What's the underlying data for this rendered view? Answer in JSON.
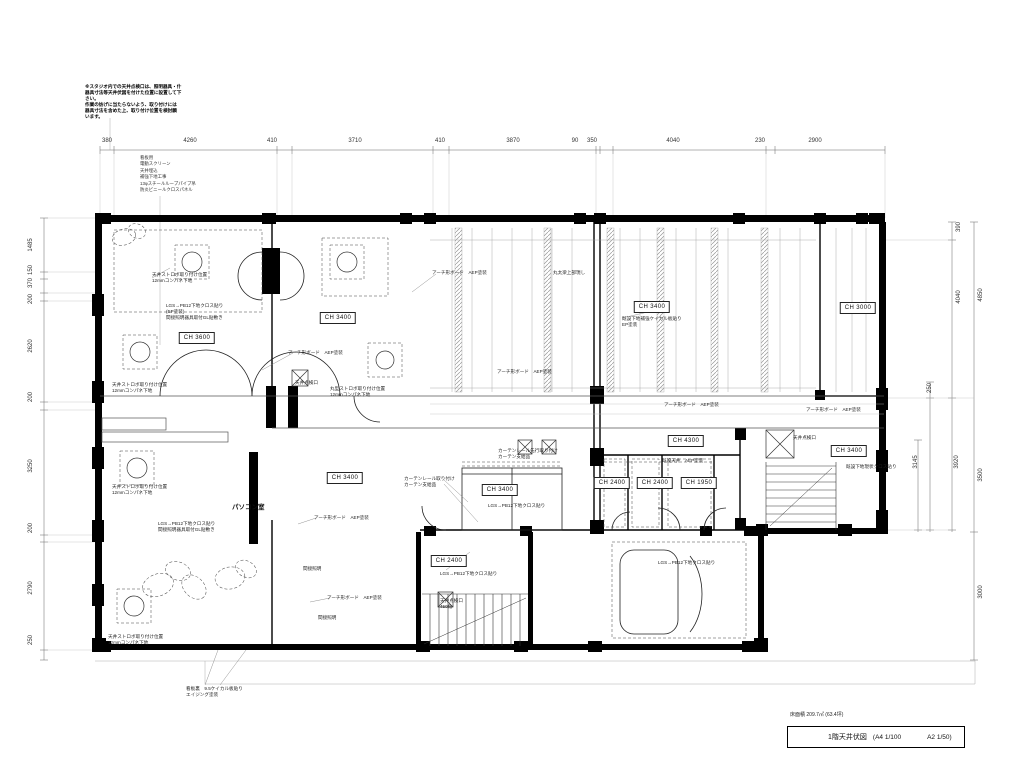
{
  "drawing": {
    "notes_block": "※スタジオ内での天井点検口は、照明器具・什\n器具寸法等天井伏図を付けた位置に設置して下\nさい。\n作業の妨げに当たらないよう、取り付けには\n器具寸法を含めた上、取り付け位置を検討願\nいます。",
    "leader_list": "看板用\n電動スクリーン\n天井埋込\n補強下地工事\n13φスチールループパイプ吊\n防炎ビニールクロスパネル",
    "room_label": "パソコン室",
    "dimensions": {
      "top": [
        "380",
        "4260",
        "410",
        "3710",
        "410",
        "3870",
        "90",
        "350",
        "4040",
        "230",
        "2900"
      ],
      "left": [
        "1485",
        "150",
        "370",
        "200",
        "2620",
        "200",
        "3250",
        "200",
        "2790",
        "250"
      ],
      "right": [
        "390",
        "4040",
        "4850",
        "250",
        "3145",
        "3920",
        "3500",
        "3000"
      ]
    },
    "ceiling_heights": [
      "CH 3600",
      "CH 3400",
      "CH 3400",
      "CH 3000",
      "CH 4300",
      "CH 3400",
      "CH 3400",
      "CH 3400",
      "CH 2400",
      "CH 2400",
      "CH 1950",
      "CH 2400"
    ],
    "annotations": [
      "天井ストロボ取り付け位置\n12mmコンパネ下地",
      "LGS→PB12下地クロス貼り\n(EP塗装)\n間接照明器具取付GL貼敷き",
      "天井ストロボ取り付け位置\n12mmコンパネ下地",
      "天井ストロボ取り付け位置\n12mmコンパネ下地",
      "アーチ形ボード　AEP塗装",
      "天井点検口",
      "丸型ストロボ取り付け位置\n12mmコンパネ下地",
      "アーチ形ボード　AEP塗装",
      "丸太梁上部現し",
      "既設下地補強ケイカル板貼り\nEP塗装",
      "アーチ形ボード　AEP塗装",
      "アーチ形ボード　AEP塗装",
      "アーチ形ボード　AEP塗装",
      "既設天井　AEP塗装",
      "既設下地現状クロス貼り",
      "カーテンレール取り付け\nカーテン支給品",
      "カーテンレール先行取り付け\nカーテン支給品",
      "LGS→PB12下地クロス貼り",
      "LGS→PB12下地クロス貼り\n間接照明器具取付GL貼敷き",
      "アーチ形ボード　AEP塗装",
      "間接照明",
      "アーチ形ボード　AEP塗装",
      "間接照明",
      "LGS→PB12下地クロス貼り",
      "天井点検口\n450角",
      "LGS→PB12下地クロス貼り",
      "天井点検口",
      "看板裏　9.5ケイカル板貼り\nエイジング塗装",
      "天井ストロボ取り付け位置\n12mmコンパネ下地"
    ],
    "title_block": {
      "area": "床面積 209.7㎡ (63.4坪)",
      "title": "1階天井伏図",
      "scale_a4": "(A4 1/100",
      "scale_a2": "A2 1/50)"
    }
  }
}
